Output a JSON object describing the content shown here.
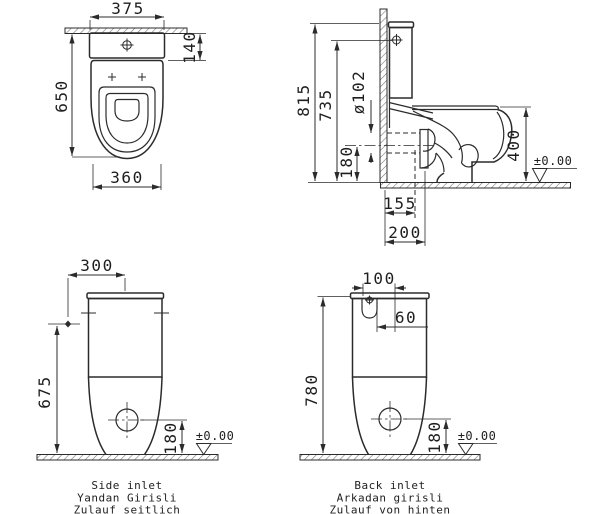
{
  "drawing": {
    "plan_view": {
      "dim_cistern_width": "375",
      "dim_cistern_depth": "140",
      "dim_total_depth": "650",
      "dim_bowl_width": "360"
    },
    "side_view": {
      "dim_total_height": "815",
      "dim_button_height": "735",
      "dim_outlet_diameter": "ø102",
      "dim_outlet_axis_height": "180",
      "dim_rim_height": "400",
      "dim_wall_to_outlet_axis": "155",
      "dim_wall_to_outlet_end": "200",
      "floor_level": "±0.00"
    },
    "front_view_side_inlet": {
      "dim_inlet_offset": "300",
      "dim_inlet_height": "675",
      "dim_waste_height": "180",
      "floor_level": "±0.00",
      "caption": [
        "Side inlet",
        "Yandan Girisli",
        "Zulauf seitlich"
      ]
    },
    "front_view_back_inlet": {
      "dim_inlet_width": "100",
      "dim_inlet_offset": "60",
      "dim_total_height": "780",
      "dim_waste_height": "180",
      "floor_level": "±0.00",
      "caption": [
        "Back inlet",
        "Arkadan girisli",
        "Zulauf von hinten"
      ]
    }
  }
}
